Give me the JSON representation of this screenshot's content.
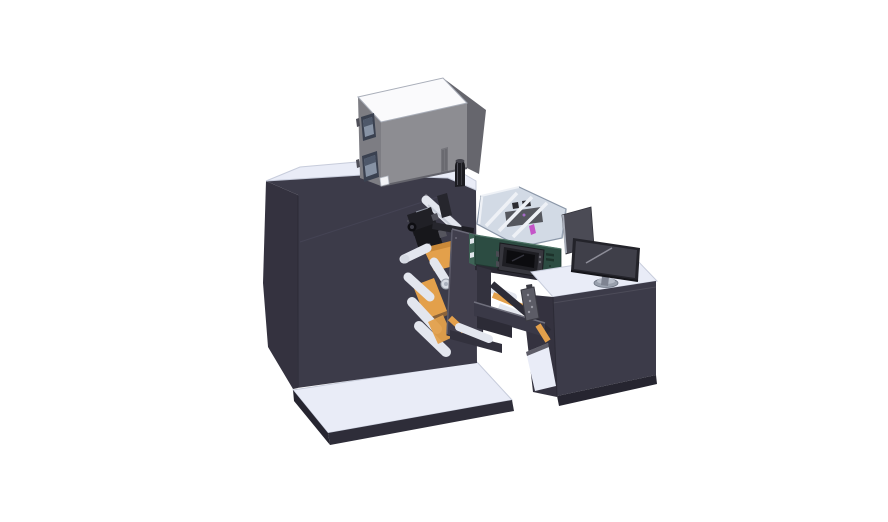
{
  "background": "#ffffff",
  "illustration": {
    "type": "3d-cad-render",
    "subject": "label printing / converting machine with operator desk and monitor",
    "parts": [
      "base-platform",
      "main-cabinet",
      "top-enclosure",
      "enclosure-window",
      "control-knob",
      "print-head",
      "upper-roller",
      "web-material",
      "web-rollers",
      "faceplate",
      "clear-guard",
      "electronics-module",
      "module-display",
      "bridge-arm",
      "operator-desk",
      "desk-shelf",
      "desk-monitor",
      "monitor-side-panel",
      "hand-controller"
    ]
  },
  "palette": {
    "bg": "#ffffff",
    "surfaceLight": "#e9ecf7",
    "surfaceEdge": "#c7ccdb",
    "darkPanel": "#3c3b49",
    "darkPanelSide": "#34323f",
    "darkEdge": "#2e2d39",
    "kick": "#262530",
    "boxFront": "#8d8d92",
    "boxSide": "#7d7d83",
    "boxDark": "#66666d",
    "boxTop": "#fafafc",
    "boxBand": "#74747a",
    "windowFrame": "#3a4150",
    "windowPane": "#8793a5",
    "windowPaneDark": "#4e586a",
    "white": "#f2f3f6",
    "rollerLight": "#e3e6ee",
    "rollerShade": "#b7bdca",
    "rollerCap": "#d6dae3",
    "orange": "#e3a04b",
    "orangeDark": "#bf7f31",
    "black1": "#17171b",
    "black2": "#26262d",
    "gray1": "#4f4f58",
    "plate": "#413f4d",
    "plateEdge": "#5d5c6a",
    "guardFill": "rgba(173,188,207,0.55)",
    "guardStroke": "#8b97a8",
    "strutWhite": "#eef1f6",
    "magenta": "#c455c8",
    "purple": "#a66bc8",
    "green": "#2c4c42",
    "greenLight": "#3f6457",
    "greenDark": "#1d322b",
    "greenHighlight": "#4c7264",
    "screenBezel": "#37373e",
    "screenFrame": "#1e1e23",
    "screenDark": "#0c0c0f",
    "screenGlare": "#33333c",
    "monitorBezel": "#23232a",
    "monitorScreen": "#3f3f49",
    "monitorHighlight": "#8d8d98",
    "standGray": "#7e8391",
    "baseGray": "#99a0ad",
    "baseGrayTop": "#b6bcc8",
    "panelGray": "#4b4b55",
    "panelHighlight": "#a9aeb9",
    "pendantGray": "#5c5c66",
    "pendantDots": "#9a9aa4",
    "bridge": "#3a3947",
    "bridgeTop": "#6f6f7c",
    "shadowBand": "#2a2933",
    "strut": "#2d2c37",
    "seam": "#49485a",
    "knobBody": "#1c1c21",
    "knobHi": "#4f4f58",
    "knobTop": "#44444c",
    "metalHi": "#8d93a0"
  }
}
